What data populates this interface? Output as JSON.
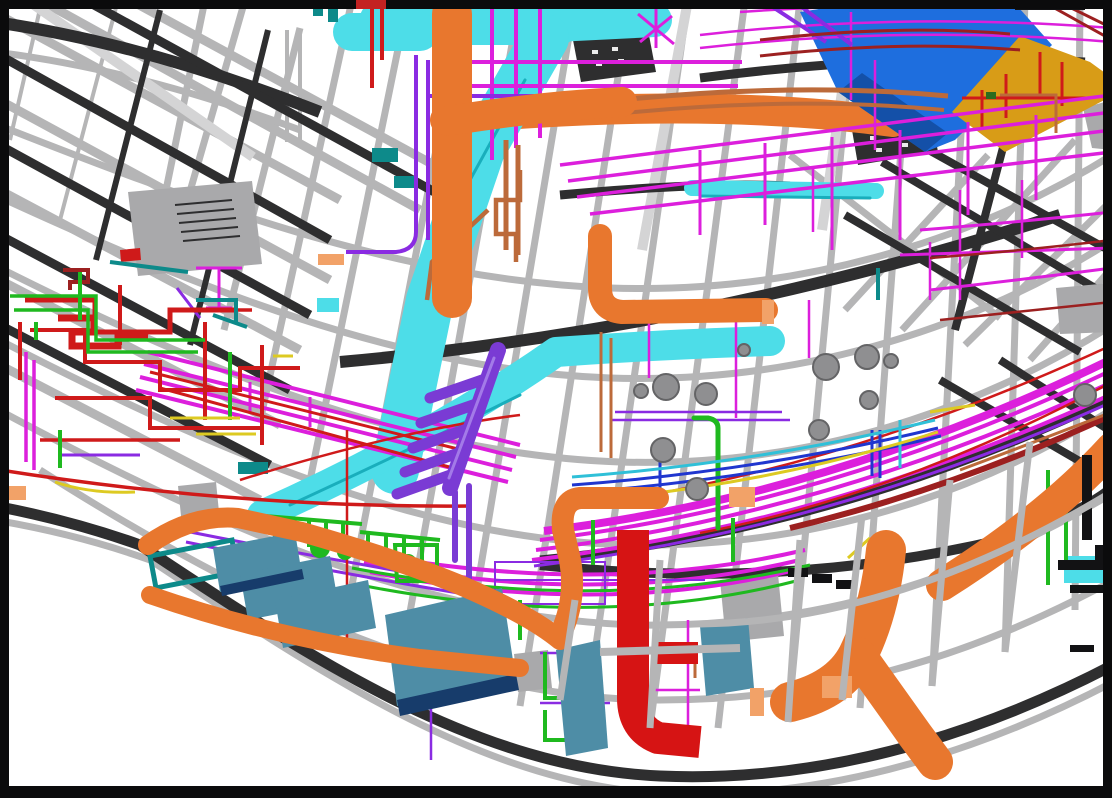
{
  "canvas": {
    "width_px": 1112,
    "height_px": 798,
    "background": "#ffffff",
    "description": "3D BIM MEP coordination model viewport: curved structural grid of a building wing with color-coded ducts, pipes and equipment. No text labels visible."
  },
  "palette": {
    "frame": "#0b0b0c",
    "accent_red": "#c32222",
    "structure_light": "#b5b5b6",
    "structure_bright": "#d4d4d5",
    "structure_dark": "#2e2e2f",
    "panel_gray": "#a9a9ab",
    "white_speck": "#ececec",
    "slab_blue": "#1e6ede",
    "slab_blue_dark": "#1450a8",
    "slab_gold": "#d89c17",
    "duct_cyan": "#4ddde8",
    "duct_cyan_dark": "#19aebc",
    "duct_orange": "#e8772e",
    "duct_orange_light": "#f2a268",
    "duct_red": "#d61414",
    "duct_purple": "#7a3bd4",
    "duct_purple_light": "#a37ae8",
    "pipe_magenta": "#dc1fdc",
    "pipe_violet": "#8a2be2",
    "pipe_red": "#cf1a1a",
    "pipe_darkred": "#9c2020",
    "pipe_green": "#1fb91f",
    "pipe_teal": "#0d8a8a",
    "pipe_copper": "#bc6a3a",
    "pipe_blue": "#2036cf",
    "pipe_lightblue": "#2fc0d8",
    "pipe_yellow": "#ddca22",
    "panel_steelblue": "#4e8da6",
    "panel_steelblue_edge": "#173c6b",
    "sphere_gray": "#8f8f91",
    "sphere_edge": "#646466",
    "black_detail": "#121214"
  },
  "legend": {
    "structure": "gray curved floor/ceiling grid beams and radial spokes",
    "cyan": "large HVAC supply ductwork",
    "orange": "large HVAC ductwork (second system)",
    "red_duct": "vertical exhaust duct with elbow",
    "purple": "branch duct manifold",
    "magenta": "piping bundles following building arc",
    "green": "piping and floor-mounted fittings",
    "steelblue": "equipment panels / trays",
    "blue_gold_slabs": "sloped roof/ceiling slabs (top right)",
    "spheres": "ball fittings / valve bodies on risers"
  },
  "counts": {
    "spheres": 12,
    "steelblue_panels": 6,
    "ring_arcs": 7
  }
}
